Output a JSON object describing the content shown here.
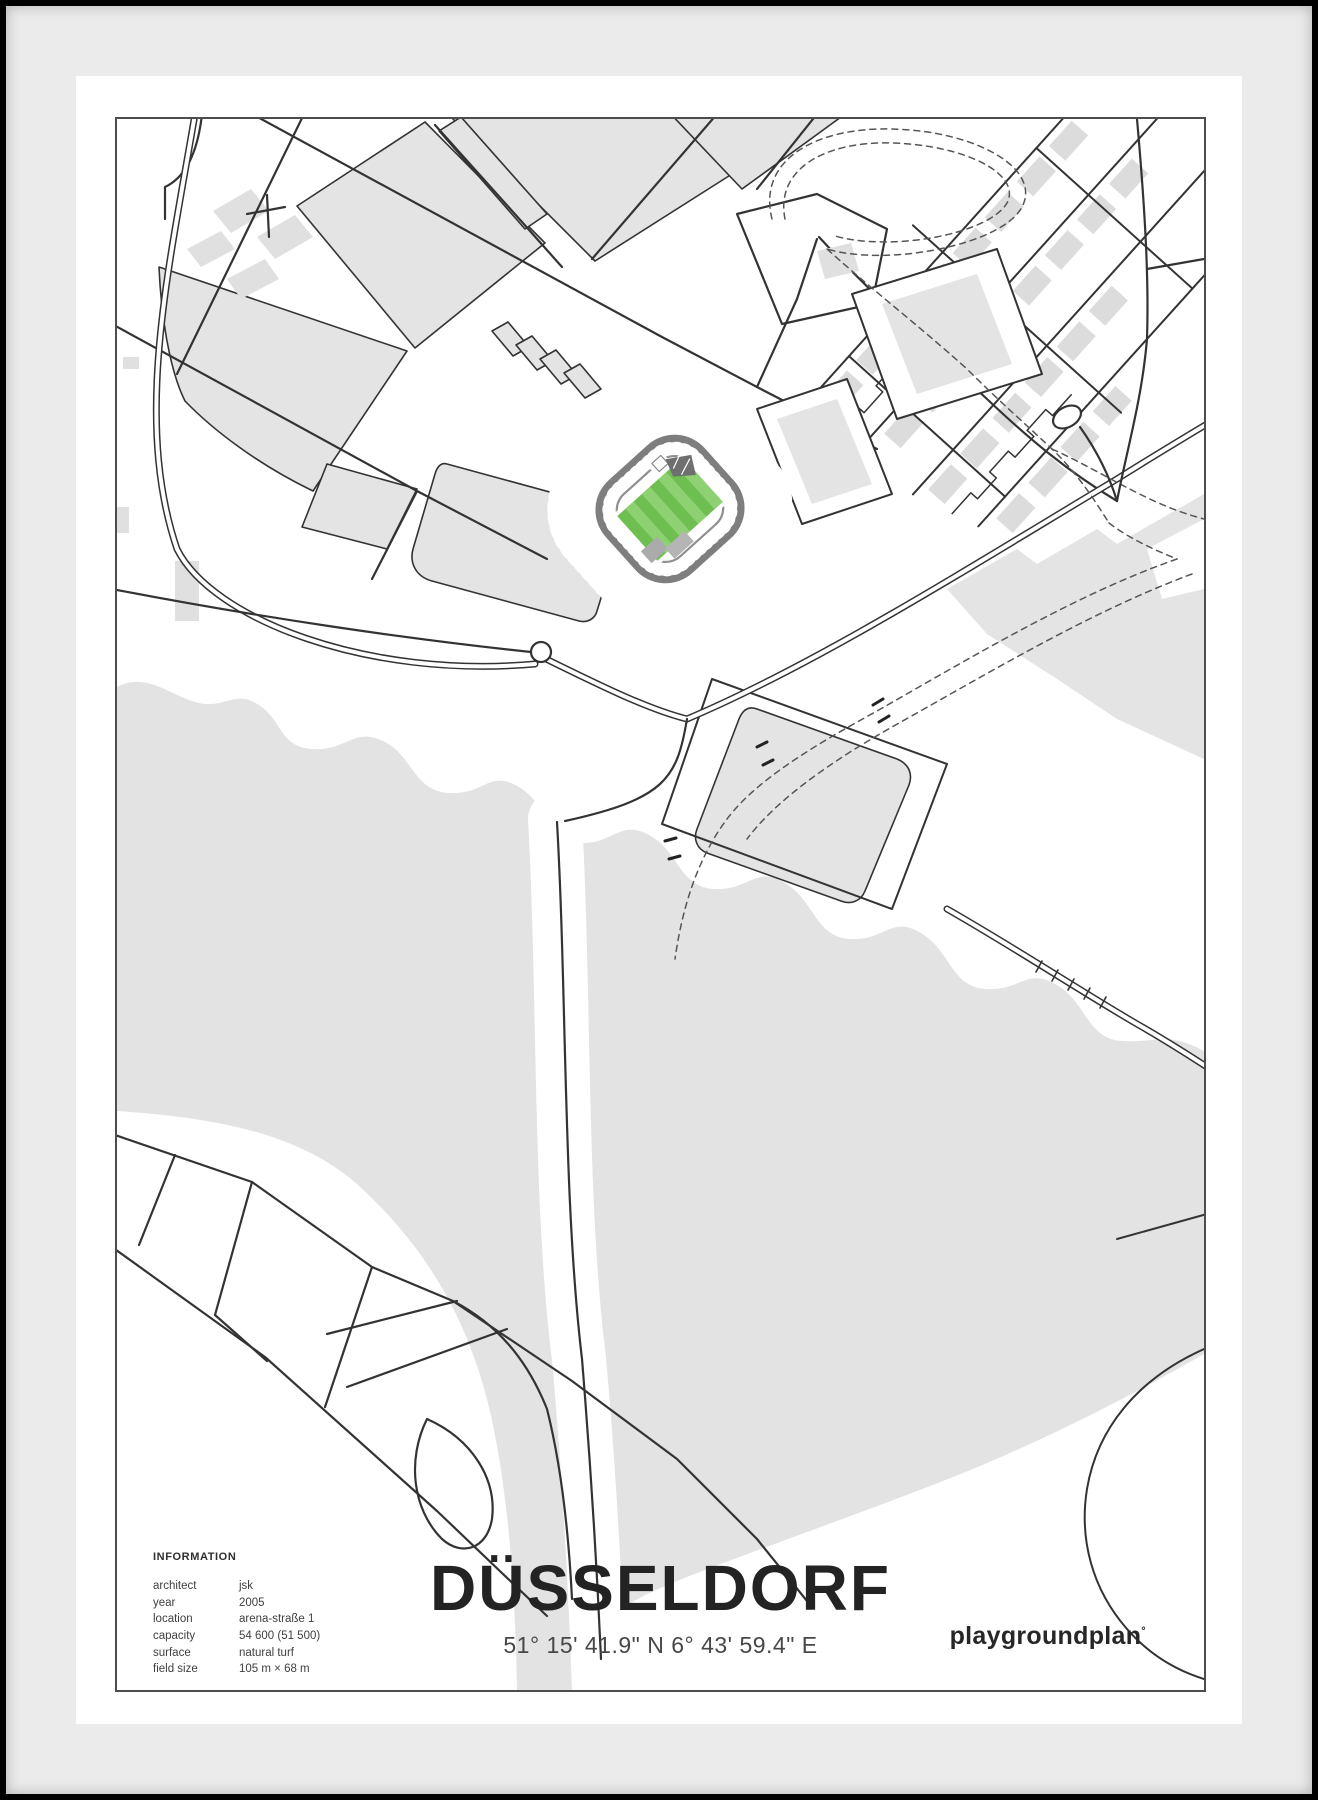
{
  "poster": {
    "title": "DÜSSELDORF",
    "coordinates": "51° 15' 41.9\" N  6° 43' 59.4\" E"
  },
  "info": {
    "heading": "INFORMATION",
    "rows": [
      {
        "label": "architect",
        "value": "jsk"
      },
      {
        "label": "year",
        "value": "2005"
      },
      {
        "label": "location",
        "value": "arena-straße 1"
      },
      {
        "label": "capacity",
        "value": "54 600 (51 500)"
      },
      {
        "label": "surface",
        "value": "natural turf"
      },
      {
        "label": "field size",
        "value": "105 m × 68 m"
      }
    ]
  },
  "brand": {
    "name": "playgroundplan",
    "mark": "°"
  },
  "map": {
    "colors": {
      "pitch_green": "#6fbe52",
      "pitch_green_light": "#8ed173",
      "building_fill": "#e4e4e4",
      "river_fill": "#e3e3e3",
      "road": "#333333",
      "stand_gray": "#d8d8d8",
      "ring_dark": "#7e7e7e",
      "frame": "#000000",
      "mat": "#ebebeb"
    }
  }
}
